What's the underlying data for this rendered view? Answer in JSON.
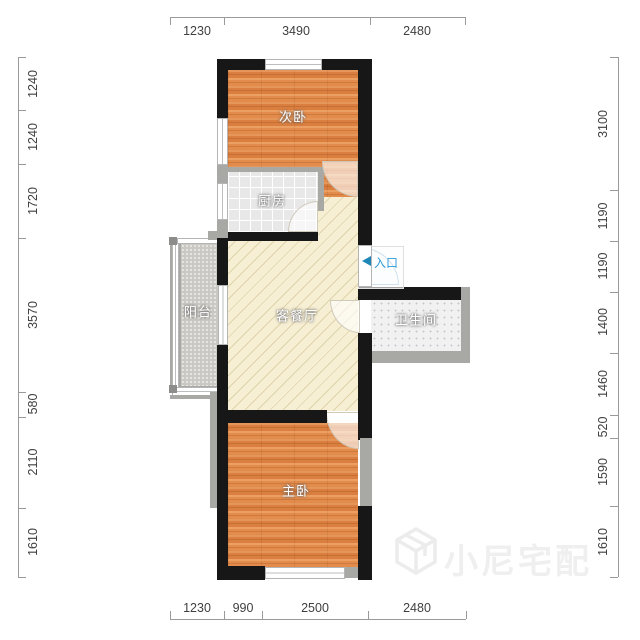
{
  "rooms": {
    "secondary_bedroom": {
      "label": "次卧"
    },
    "kitchen": {
      "label": "厨房"
    },
    "living_dining": {
      "label": "客餐厅"
    },
    "balcony": {
      "label": "阳台"
    },
    "bathroom": {
      "label": "卫生间"
    },
    "master_bedroom": {
      "label": "主卧"
    }
  },
  "entrance": {
    "label": "入口"
  },
  "watermark": {
    "text": "小尼宅配"
  },
  "dimensions": {
    "top": [
      "1230",
      "3490",
      "2480"
    ],
    "bottom": [
      "1230",
      "990",
      "2500",
      "2480"
    ],
    "left": [
      "1240",
      "1240",
      "1720",
      "3570",
      "580",
      "2110",
      "1610"
    ],
    "right": [
      "3100",
      "1190",
      "1190",
      "1400",
      "1460",
      "520",
      "1590",
      "1610"
    ]
  },
  "colors": {
    "wall": "#171717",
    "wall_secondary": "#a8a8a5",
    "bedroom_floor": "#de8547",
    "living_floor": "#f7efd4",
    "kitchen_floor": "#e8e8e8",
    "balcony_floor": "#c9c8c2",
    "bathroom_floor": "#f1f1f1",
    "entrance_blue": "#2e9bd6",
    "dimension_text": "#3f3f3f",
    "watermark_gray": "#efefef"
  }
}
